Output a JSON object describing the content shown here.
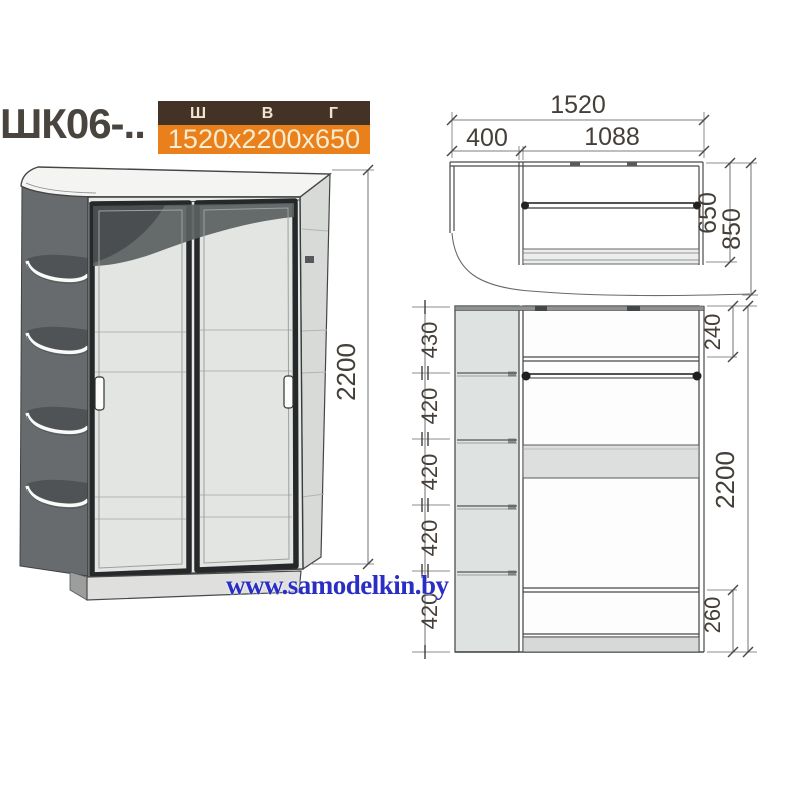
{
  "header": {
    "model": "ШК06-..",
    "spec_columns": [
      "Ш",
      "В",
      "Г"
    ],
    "dimensions": "1520x2200x650"
  },
  "watermark": {
    "text": "www.samodelkin.by"
  },
  "colors": {
    "table_header_bg": "#453227",
    "table_value_bg": "#e9801c",
    "table_text": "#f6ecd0",
    "watermark_blue": "#2a2ec4"
  },
  "views": {
    "perspective": {
      "height_total": "2200"
    },
    "plan": {
      "width_total": "1520",
      "width_corner": "400",
      "width_doors": "1088",
      "depth_body": "650",
      "depth_total": "850"
    },
    "front": {
      "left_segments": [
        "430",
        "420",
        "420",
        "420",
        "420"
      ],
      "top_section": "240",
      "height_total": "2200",
      "bottom_section": "260"
    }
  }
}
